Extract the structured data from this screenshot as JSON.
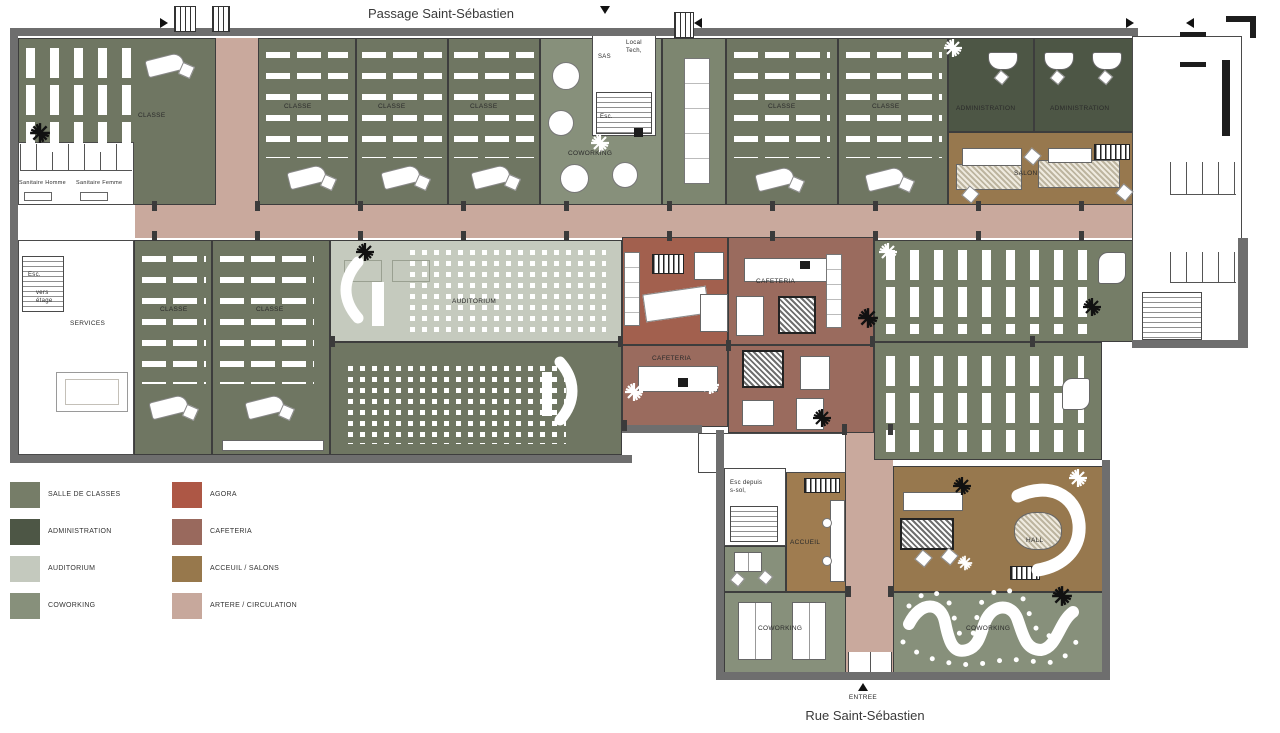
{
  "streets": {
    "top": "Passage Saint-Sébastien",
    "bottom": "Rue Saint-Sébastien"
  },
  "entrance": {
    "label": "ENTREE"
  },
  "legend": {
    "items": [
      {
        "label": "SALLE DE CLASSES",
        "color": "#767d68"
      },
      {
        "label": "ADMINISTRATION",
        "color": "#4d5645"
      },
      {
        "label": "AUDITORIUM",
        "color": "#c4c9be"
      },
      {
        "label": "COWORKING",
        "color": "#87907b"
      },
      {
        "label": "AGORA",
        "color": "#ad5745"
      },
      {
        "label": "CAFETERIA",
        "color": "#99695d"
      },
      {
        "label": "ACCEUIL / SALONS",
        "color": "#97784c"
      },
      {
        "label": "ARTERE / CIRCULATION",
        "color": "#c7a89c"
      }
    ]
  },
  "rooms": {
    "classe": "CLASSE",
    "coworking": "COWORKING",
    "administration": "ADMINISTRATION",
    "salon": "SALON",
    "services": "SERVICES",
    "auditorium": "AUDITORIUM",
    "cafeteria": "CAFETERIA",
    "accueil": "ACCUEIL",
    "hall": "HALL",
    "sas": "SAS",
    "local_tech": "Local Tech,",
    "esc": "Esc.",
    "vers_etage": "vers étage",
    "esc_sous_sol": "Esc depuis s-sol,",
    "sanitaire_homme": "Sanitaire Homme",
    "sanitaire_femme": "Sanitaire Femme"
  }
}
